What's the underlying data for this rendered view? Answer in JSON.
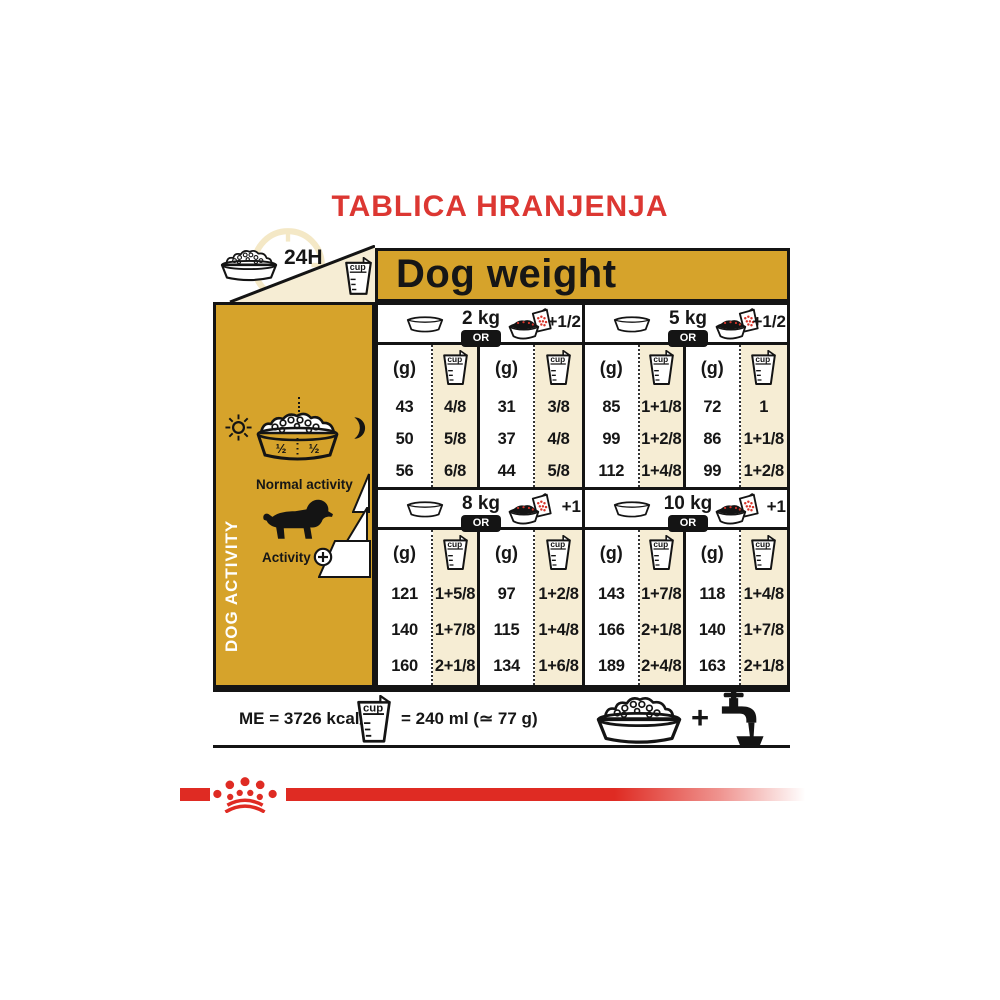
{
  "title": "TABLICA HRANJENJA",
  "header": {
    "hours_label": "24H",
    "dog_weight_label": "Dog weight"
  },
  "sidebar": {
    "label": "DOG ACTIVITY",
    "bowl_half_left": "½",
    "bowl_half_right": "½",
    "normal_activity_label": "Normal activity",
    "activity_label": "Activity",
    "activity_plus": "+"
  },
  "table": {
    "or_label": "OR",
    "grams_unit": "(g)",
    "cup_unit": "cup",
    "blocks": [
      {
        "weight": "2 kg",
        "extra": "+1/2",
        "g1": [
          "43",
          "50",
          "56"
        ],
        "cup1": [
          "4/8",
          "5/8",
          "6/8"
        ],
        "g2": [
          "31",
          "37",
          "44"
        ],
        "cup2": [
          "3/8",
          "4/8",
          "5/8"
        ]
      },
      {
        "weight": "5 kg",
        "extra": "+1/2",
        "g1": [
          "85",
          "99",
          "112"
        ],
        "cup1": [
          "1+1/8",
          "1+2/8",
          "1+4/8"
        ],
        "g2": [
          "72",
          "86",
          "99"
        ],
        "cup2": [
          "1",
          "1+1/8",
          "1+2/8"
        ]
      },
      {
        "weight": "8 kg",
        "extra": "+1",
        "g1": [
          "121",
          "140",
          "160"
        ],
        "cup1": [
          "1+5/8",
          "1+7/8",
          "2+1/8"
        ],
        "g2": [
          "97",
          "115",
          "134"
        ],
        "cup2": [
          "1+2/8",
          "1+4/8",
          "1+6/8"
        ]
      },
      {
        "weight": "10 kg",
        "extra": "+1",
        "g1": [
          "143",
          "166",
          "189"
        ],
        "cup1": [
          "1+7/8",
          "2+1/8",
          "2+4/8"
        ],
        "g2": [
          "118",
          "140",
          "163"
        ],
        "cup2": [
          "1+4/8",
          "1+7/8",
          "2+1/8"
        ]
      }
    ]
  },
  "footer": {
    "me_label": "ME = 3726 kcal/kg",
    "cup_equivalence": "= 240 ml (≃ 77 g)",
    "plus_sign": "+"
  },
  "colors": {
    "gold": "#D6A32B",
    "cream": "#F6EDD4",
    "title_red": "#DC3732",
    "brand_red": "#DF2B23",
    "ink": "#141414"
  },
  "icons": {
    "kibble_bowl": "bowl-of-kibble",
    "empty_bowl": "empty-bowl",
    "measuring_cup": "measuring-cup",
    "wet_pouch": "pouch-with-bowl",
    "sun": "sun",
    "moon": "crescent-moon",
    "dog": "dachshund-silhouette",
    "plus_circle": "circle-plus",
    "water_tap": "tap-with-water-bowl",
    "crown": "royal-canin-crown",
    "clock": "24h-clock"
  }
}
